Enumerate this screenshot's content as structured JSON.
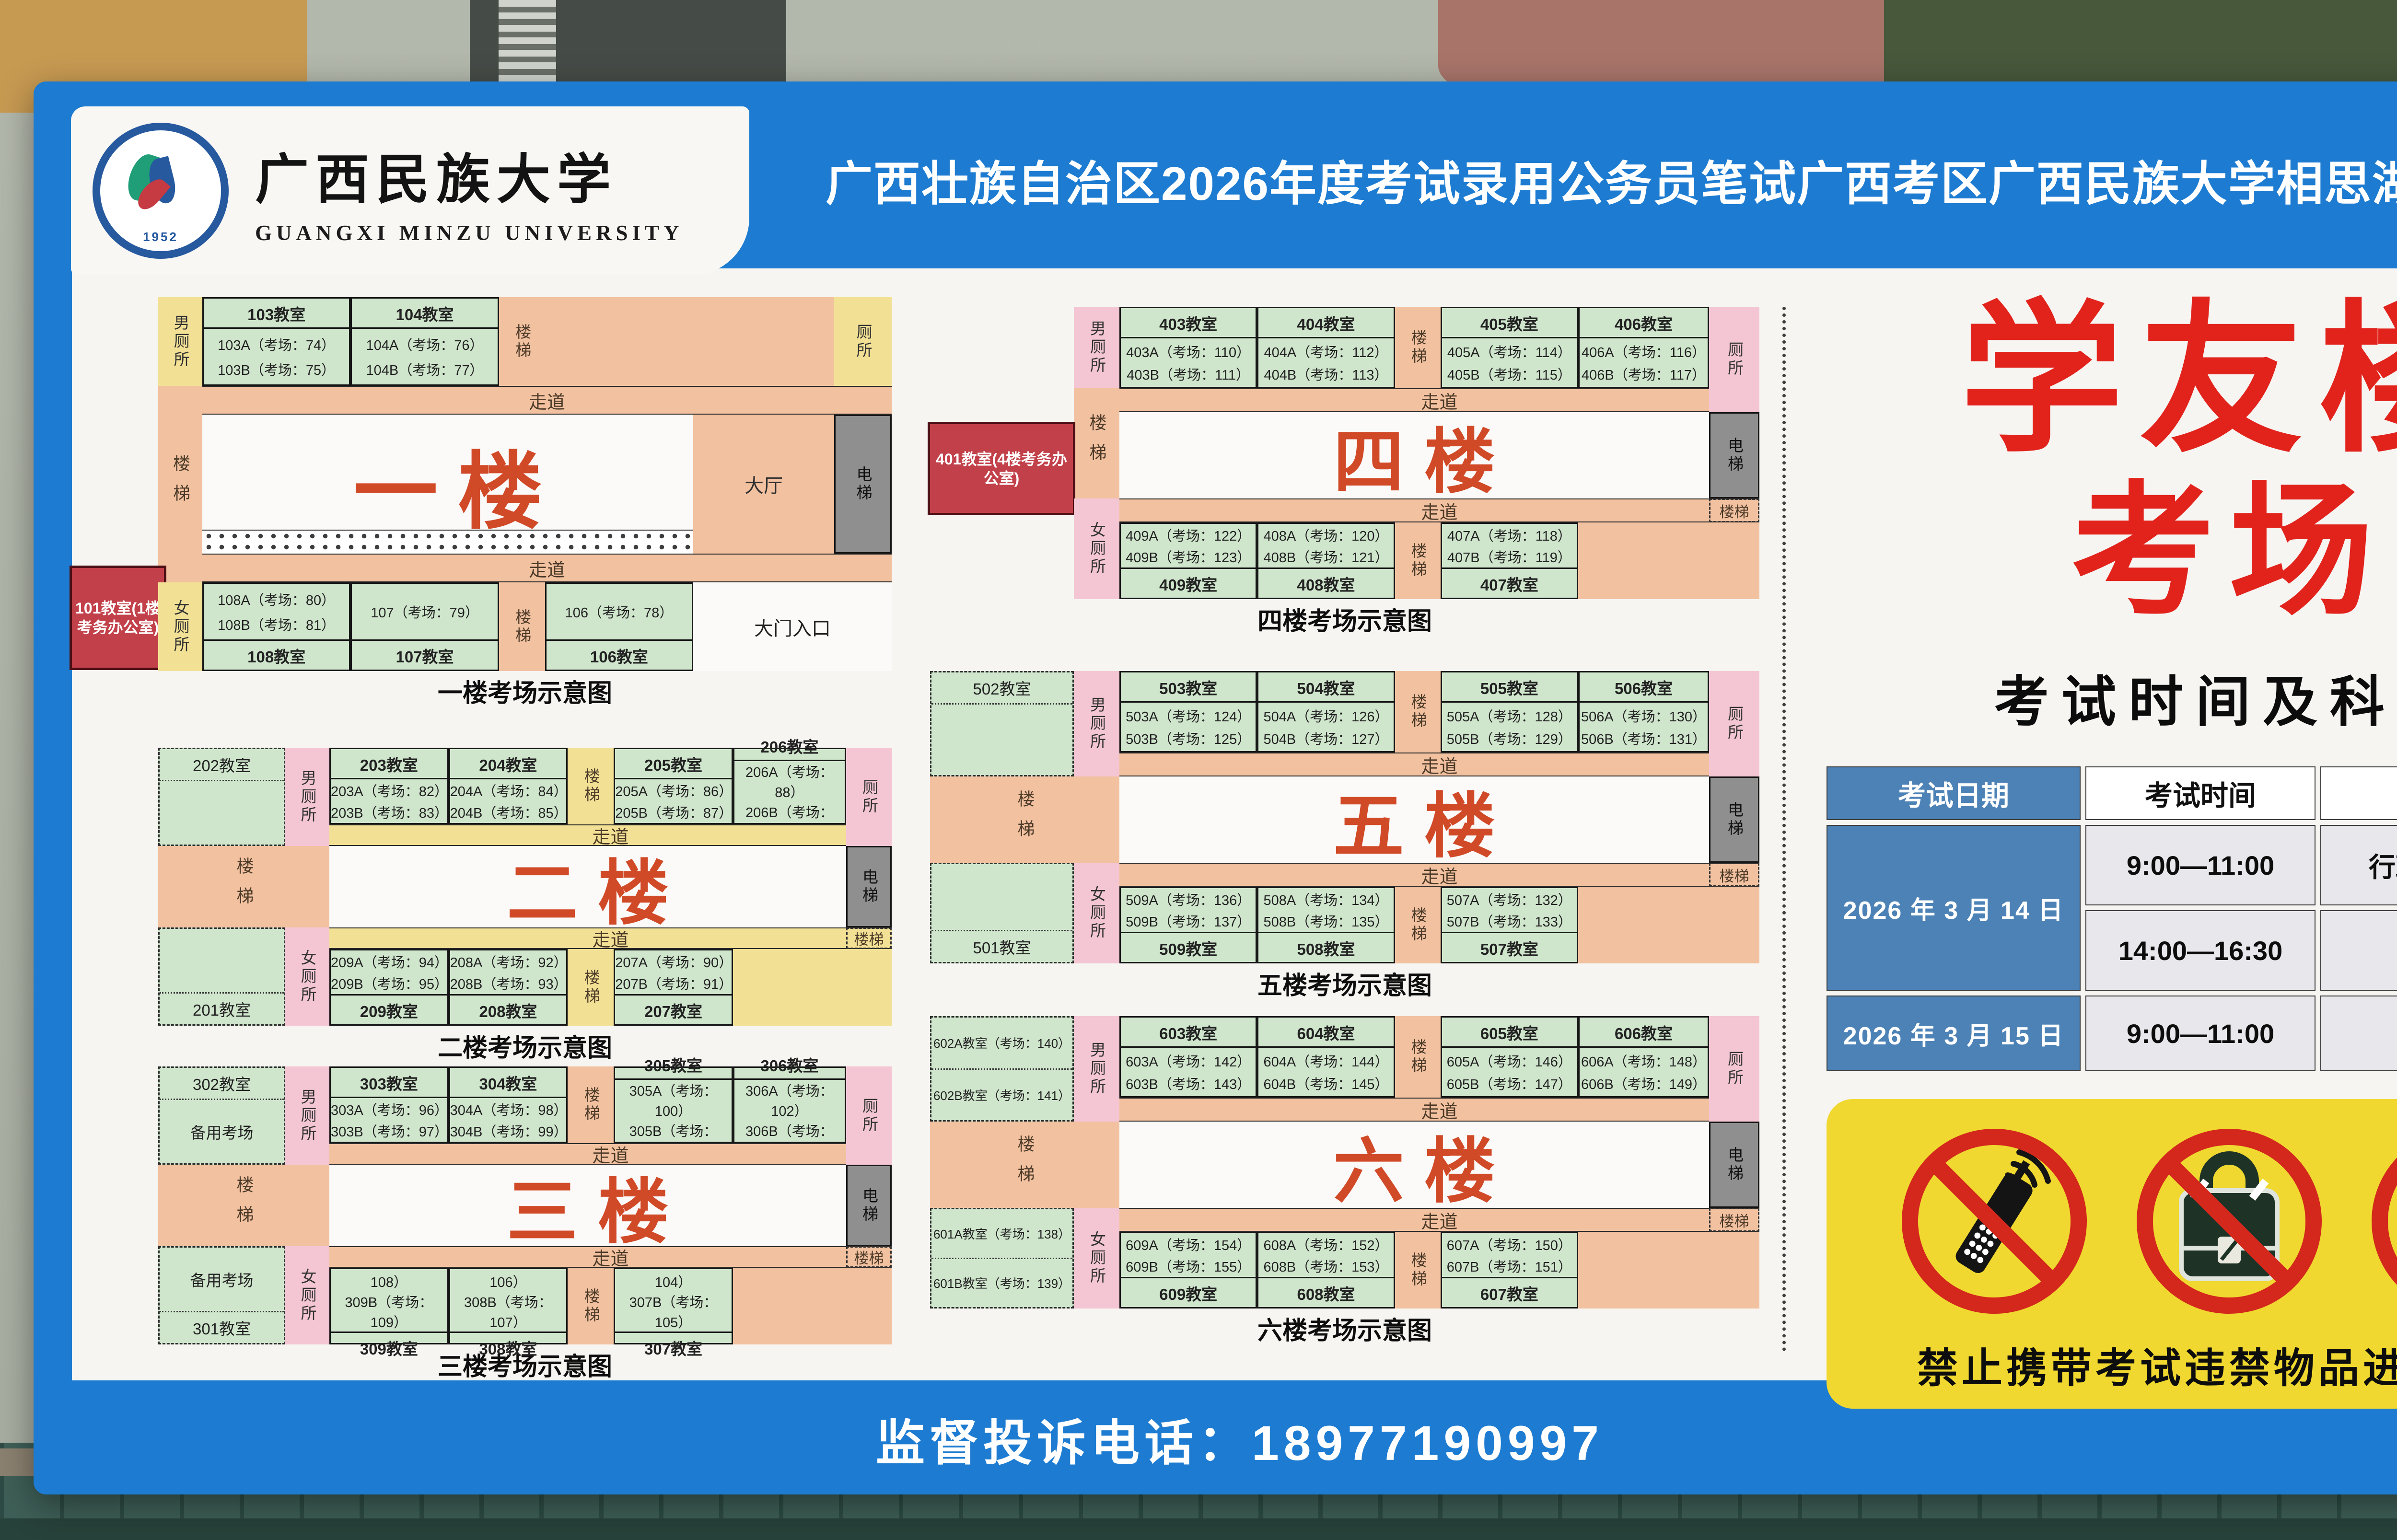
{
  "header": {
    "university_cn": "广西民族大学",
    "university_en": "GUANGXI MINZU UNIVERSITY",
    "seal_year": "1952",
    "banner_title": "广西壮族自治区2026年度考试录用公务员笔试广西考区广西民族大学相思湖校区考点"
  },
  "floors": [
    {
      "hall": "一楼",
      "caption": "一楼考场示意图",
      "corridor_top": "走道",
      "corridor_bottom": "走道",
      "stair_left": "楼梯",
      "stair_top": "楼梯",
      "stair_bottom": "楼梯",
      "elevator": "电梯",
      "hall_side": "大厅",
      "entrance": "大门入口",
      "toilet_top": "男厕所",
      "toilet_top_right": "厕所",
      "toilet_bottom": "女厕所",
      "office_box": "101教室(1楼考务办公室)",
      "rooms_top": [
        {
          "title": "103教室",
          "lines": [
            "103A（考场：74）",
            "103B（考场：75）"
          ]
        },
        {
          "title": "104教室",
          "lines": [
            "104A（考场：76）",
            "104B（考场：77）"
          ]
        }
      ],
      "rooms_bottom": [
        {
          "title": "108教室",
          "lines": [
            "108A（考场：80）",
            "108B（考场：81）"
          ]
        },
        {
          "title": "107教室",
          "lines": [
            "107（考场：79）"
          ]
        },
        {
          "title": "106教室",
          "lines": [
            "106（考场：78）"
          ]
        }
      ]
    },
    {
      "hall": "二楼",
      "caption": "二楼考场示意图",
      "corridor_top": "走道",
      "corridor_bottom": "走道",
      "stair_left": "楼梯",
      "stair_top": "楼梯",
      "stair_bottom": "楼梯",
      "stair_right": "楼梯",
      "elevator": "电梯",
      "toilet_top": "男厕所",
      "toilet_top_right": "厕所",
      "toilet_bottom": "女厕所",
      "left_top": {
        "title": "202教室"
      },
      "left_bottom": {
        "title": "201教室"
      },
      "rooms_top": [
        {
          "title": "203教室",
          "lines": [
            "203A（考场：82）",
            "203B（考场：83）"
          ]
        },
        {
          "title": "204教室",
          "lines": [
            "204A（考场：84）",
            "204B（考场：85）"
          ]
        },
        {
          "title": "205教室",
          "lines": [
            "205A（考场：86）",
            "205B（考场：87）"
          ]
        },
        {
          "title": "206教室",
          "lines": [
            "206A（考场：88）",
            "206B（考场：89）"
          ]
        }
      ],
      "rooms_bottom": [
        {
          "title": "209教室",
          "lines": [
            "209A（考场：94）",
            "209B（考场：95）"
          ]
        },
        {
          "title": "208教室",
          "lines": [
            "208A（考场：92）",
            "208B（考场：93）"
          ]
        },
        {
          "title": "207教室",
          "lines": [
            "207A（考场：90）",
            "207B（考场：91）"
          ]
        }
      ]
    },
    {
      "hall": "三楼",
      "caption": "三楼考场示意图",
      "corridor_top": "走道",
      "corridor_bottom": "走道",
      "stair_left": "楼梯",
      "stair_top": "楼梯",
      "stair_bottom": "楼梯",
      "stair_right": "楼梯",
      "elevator": "电梯",
      "toilet_top": "男厕所",
      "toilet_top_right": "厕所",
      "toilet_bottom": "女厕所",
      "left_top": {
        "title": "302教室",
        "body": "备用考场"
      },
      "left_bottom": {
        "title": "301教室",
        "body": "备用考场"
      },
      "rooms_top": [
        {
          "title": "303教室",
          "lines": [
            "303A（考场：96）",
            "303B（考场：97）"
          ]
        },
        {
          "title": "304教室",
          "lines": [
            "304A（考场：98）",
            "304B（考场：99）"
          ]
        },
        {
          "title": "305教室",
          "lines": [
            "305A（考场：100）",
            "305B（考场：101）"
          ]
        },
        {
          "title": "306教室",
          "lines": [
            "306A（考场：102）",
            "306B（考场：103）"
          ]
        }
      ],
      "rooms_bottom": [
        {
          "title": "309教室",
          "lines": [
            "309A（考场：108）",
            "309B（考场：109）"
          ]
        },
        {
          "title": "308教室",
          "lines": [
            "308A（考场：106）",
            "308B（考场：107）"
          ]
        },
        {
          "title": "307教室",
          "lines": [
            "307A（考场：104）",
            "307B（考场：105）"
          ]
        }
      ]
    },
    {
      "hall": "四楼",
      "caption": "四楼考场示意图",
      "corridor_top": "走道",
      "corridor_bottom": "走道",
      "stair_left": "楼梯",
      "stair_top": "楼梯",
      "stair_bottom": "楼梯",
      "stair_right": "楼梯",
      "elevator": "电梯",
      "toilet_top": "男厕所",
      "toilet_top_right": "厕所",
      "toilet_bottom": "女厕所",
      "office_box": "401教室(4楼考务办公室)",
      "rooms_top": [
        {
          "title": "403教室",
          "lines": [
            "403A（考场：110）",
            "403B（考场：111）"
          ]
        },
        {
          "title": "404教室",
          "lines": [
            "404A（考场：112）",
            "404B（考场：113）"
          ]
        },
        {
          "title": "405教室",
          "lines": [
            "405A（考场：114）",
            "405B（考场：115）"
          ]
        },
        {
          "title": "406教室",
          "lines": [
            "406A（考场：116）",
            "406B（考场：117）"
          ]
        }
      ],
      "rooms_bottom": [
        {
          "title": "409教室",
          "lines": [
            "409A（考场：122）",
            "409B（考场：123）"
          ]
        },
        {
          "title": "408教室",
          "lines": [
            "408A（考场：120）",
            "408B（考场：121）"
          ]
        },
        {
          "title": "407教室",
          "lines": [
            "407A（考场：118）",
            "407B（考场：119）"
          ]
        }
      ]
    },
    {
      "hall": "五楼",
      "caption": "五楼考场示意图",
      "corridor_top": "走道",
      "corridor_bottom": "走道",
      "stair_left": "楼梯",
      "stair_top": "楼梯",
      "stair_bottom": "楼梯",
      "stair_right": "楼梯",
      "elevator": "电梯",
      "toilet_top": "男厕所",
      "toilet_top_right": "厕所",
      "toilet_bottom": "女厕所",
      "left_top": {
        "title": "502教室"
      },
      "left_bottom": {
        "title": "501教室"
      },
      "rooms_top": [
        {
          "title": "503教室",
          "lines": [
            "503A（考场：124）",
            "503B（考场：125）"
          ]
        },
        {
          "title": "504教室",
          "lines": [
            "504A（考场：126）",
            "504B（考场：127）"
          ]
        },
        {
          "title": "505教室",
          "lines": [
            "505A（考场：128）",
            "505B（考场：129）"
          ]
        },
        {
          "title": "506教室",
          "lines": [
            "506A（考场：130）",
            "506B（考场：131）"
          ]
        }
      ],
      "rooms_bottom": [
        {
          "title": "509教室",
          "lines": [
            "509A（考场：136）",
            "509B（考场：137）"
          ]
        },
        {
          "title": "508教室",
          "lines": [
            "508A（考场：134）",
            "508B（考场：135）"
          ]
        },
        {
          "title": "507教室",
          "lines": [
            "507A（考场：132）",
            "507B（考场：133）"
          ]
        }
      ]
    },
    {
      "hall": "六楼",
      "caption": "六楼考场示意图",
      "corridor_top": "走道",
      "corridor_bottom": "走道",
      "stair_left": "楼梯",
      "stair_top": "楼梯",
      "stair_bottom": "楼梯",
      "stair_right": "楼梯",
      "elevator": "电梯",
      "toilet_top": "男厕所",
      "toilet_top_right": "厕所",
      "toilet_bottom": "女厕所",
      "left_top": {
        "lines": [
          "602A教室（考场：140）",
          "602B教室（考场：141）"
        ]
      },
      "left_bottom": {
        "lines": [
          "601A教室（考场：138）",
          "601B教室（考场：139）"
        ]
      },
      "rooms_top": [
        {
          "title": "603教室",
          "lines": [
            "603A（考场：142）",
            "603B（考场：143）"
          ]
        },
        {
          "title": "604教室",
          "lines": [
            "604A（考场：144）",
            "604B（考场：145）"
          ]
        },
        {
          "title": "605教室",
          "lines": [
            "605A（考场：146）",
            "605B（考场：147）"
          ]
        },
        {
          "title": "606教室",
          "lines": [
            "606A（考场：148）",
            "606B（考场：149）"
          ]
        }
      ],
      "rooms_bottom": [
        {
          "title": "609教室",
          "lines": [
            "609A（考场：154）",
            "609B（考场：155）"
          ]
        },
        {
          "title": "608教室",
          "lines": [
            "608A（考场：152）",
            "608B（考场：153）"
          ]
        },
        {
          "title": "607教室",
          "lines": [
            "607A（考场：150）",
            "607B（考场：151）"
          ]
        }
      ]
    }
  ],
  "right_panel": {
    "building_line1": "学友楼",
    "building_line2": "考场",
    "schedule_title": "考试时间及科目",
    "table": {
      "headers": [
        "考试日期",
        "考试时间",
        "考试科目"
      ],
      "rows": [
        {
          "date": "2026 年 3 月 14 日",
          "sessions": [
            {
              "time": "9:00—11:00",
              "subject": "行政职业能力测验"
            },
            {
              "time": "14:00—16:30",
              "subject": "申论"
            }
          ]
        },
        {
          "date": "2026 年 3 月 15 日",
          "sessions": [
            {
              "time": "9:00—11:00",
              "subject": "专业科目"
            }
          ]
        }
      ]
    },
    "warning_text": "禁止携带考试违禁物品进入考场",
    "warning_icons": [
      "no-phone-icon",
      "no-bag-icon",
      "no-smartwatch-icon"
    ]
  },
  "footer": {
    "hotline": "监督投诉电话：18977190997"
  },
  "colors": {
    "banner_blue": "#1d7cd1",
    "poster_bg": "#f6f5f2",
    "room_green": "#cfe6cc",
    "corridor_salmon": "#f2c1a0",
    "accent_yellow": "#f2e095",
    "toilet_pink": "#f4c6d4",
    "elevator_gray": "#8f8f8f",
    "office_red": "#c24049",
    "floor_label_orange": "#d14a28",
    "title_red": "#e2231c",
    "table_blue": "#4d82b6",
    "warning_yellow": "#f0d830",
    "prohibition_red": "#d4281c"
  }
}
